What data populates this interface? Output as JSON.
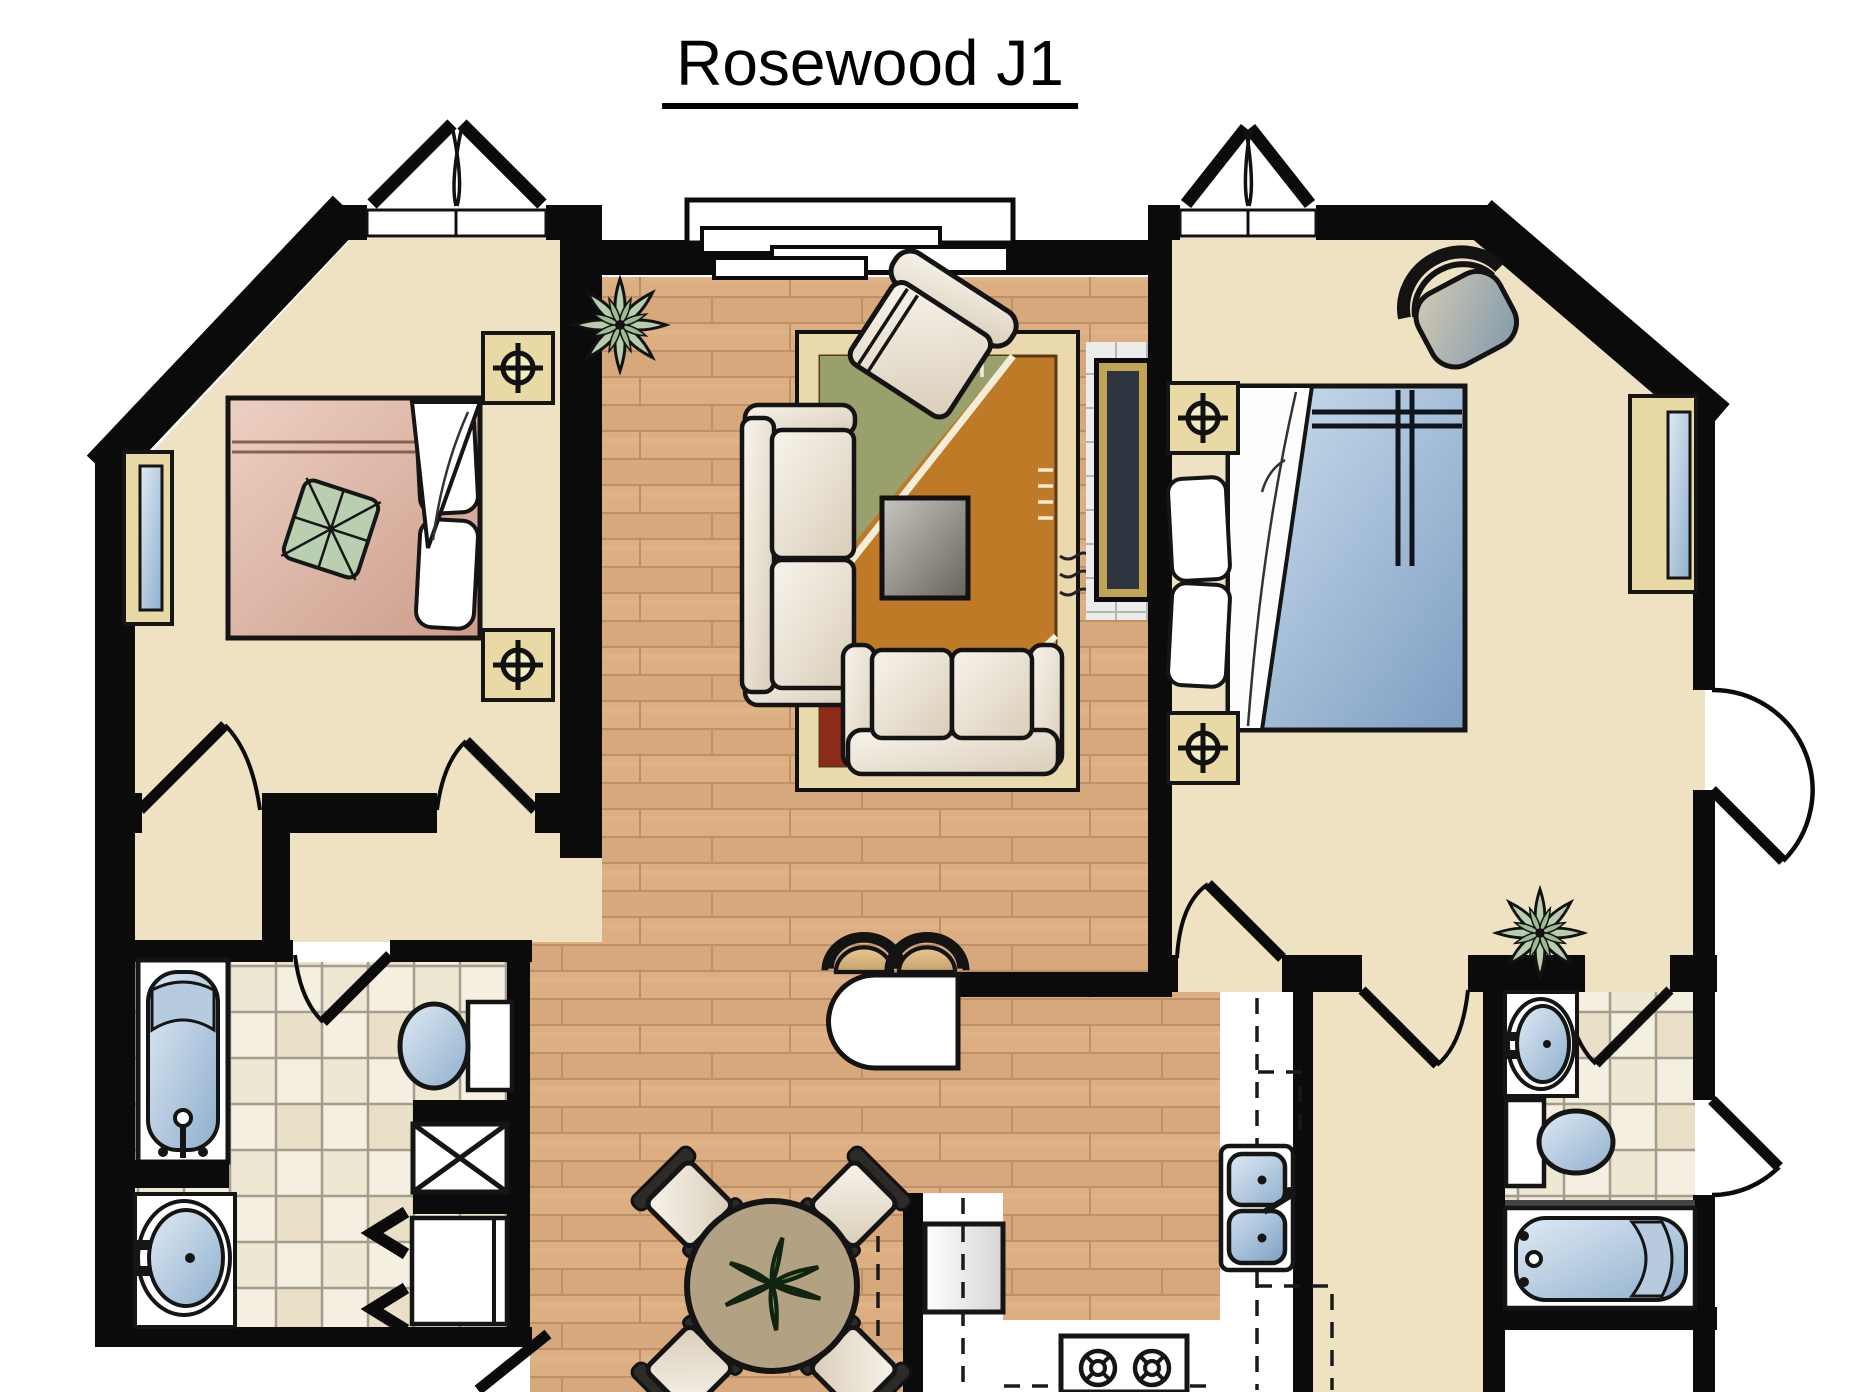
{
  "title": "Rosewood J1",
  "floor_plan": {
    "unit_name": "Rosewood J1",
    "style": "top-down architectural rendering, no room labels or dimensions printed",
    "rooms": [
      {
        "id": "bedroom-left",
        "features": [
          "french-door-top",
          "angled-corner-wall",
          "left-wall-window",
          "double-bed-pink",
          "white-pillows",
          "leaf-print-pillow",
          "nightstand-with-lamp-symbol-top",
          "nightstand-with-lamp-symbol-bottom",
          "closet-below",
          "two-swing-doors"
        ]
      },
      {
        "id": "living-room",
        "features": [
          "bay-window-top",
          "potted-plant",
          "armchair-angled",
          "sofa-left",
          "loveseat-bottom",
          "area-rug",
          "coffee-table",
          "fireplace-media-niche-on-right-wall"
        ]
      },
      {
        "id": "bedroom-right",
        "features": [
          "french-door-top",
          "angled-corner-wall",
          "corner-chair",
          "double-bed-blue",
          "white-sheet-fold",
          "white-pillows",
          "nightstand-with-lamp-symbol-top",
          "nightstand-with-lamp-symbol-bottom",
          "right-wall-window",
          "patio-door-right",
          "potted-plant",
          "walk-in-closet-below"
        ]
      },
      {
        "id": "bathroom-left",
        "features": [
          "bathtub-vertical",
          "toilet",
          "shower-stall-x",
          "vanity-sink",
          "laundry-closet-with-bifold-doors",
          "washer",
          "swing-door",
          "exterior-door-bottom"
        ]
      },
      {
        "id": "bathroom-right",
        "features": [
          "vanity-sink",
          "toilet",
          "bathtub-horizontal",
          "swing-door",
          "exterior-door-right"
        ]
      },
      {
        "id": "kitchen",
        "features": [
          "breakfast-bar-rounded",
          "two-bar-stools",
          "double-sink",
          "refrigerator",
          "range-with-burners",
          "dashed-upper-cabinet-lines"
        ]
      },
      {
        "id": "dining-area",
        "features": [
          "round-table",
          "centerpiece-plant",
          "four-chairs-diagonal"
        ]
      }
    ],
    "symbols": [
      {
        "name": "lamp-symbol",
        "meaning": "crosshair circle on tan nightstand"
      },
      {
        "name": "door-swing-arc",
        "meaning": "quarter circle with door leaf"
      },
      {
        "name": "french-door",
        "meaning": "double triangle leaves above wall"
      },
      {
        "name": "dashed-line",
        "meaning": "overhead cabinets"
      },
      {
        "name": "x-box",
        "meaning": "shower stall"
      },
      {
        "name": "chevrons",
        "meaning": "bifold closet doors"
      }
    ],
    "colors": {
      "walls": "#0b0b0b",
      "room_beige": "#efe2c2",
      "wood_floor": "#d6a87b",
      "tile_floor": "#f4efe1",
      "fixture_blue": "#8fafcd",
      "bed_blue": "#7d9ec2",
      "bed_pink": "#cc9c8b",
      "rug_border": "#ead9ae",
      "rug_orange": "#bf7a28",
      "rug_red": "#8c2b1a",
      "rug_olive": "#9aa06b",
      "accent_gold": "#c2a455",
      "nightstand_tan": "#e8d9a5",
      "plant_green": "#b7cdad",
      "stool_tan": "#d9b483",
      "title_color": "#000000"
    }
  }
}
